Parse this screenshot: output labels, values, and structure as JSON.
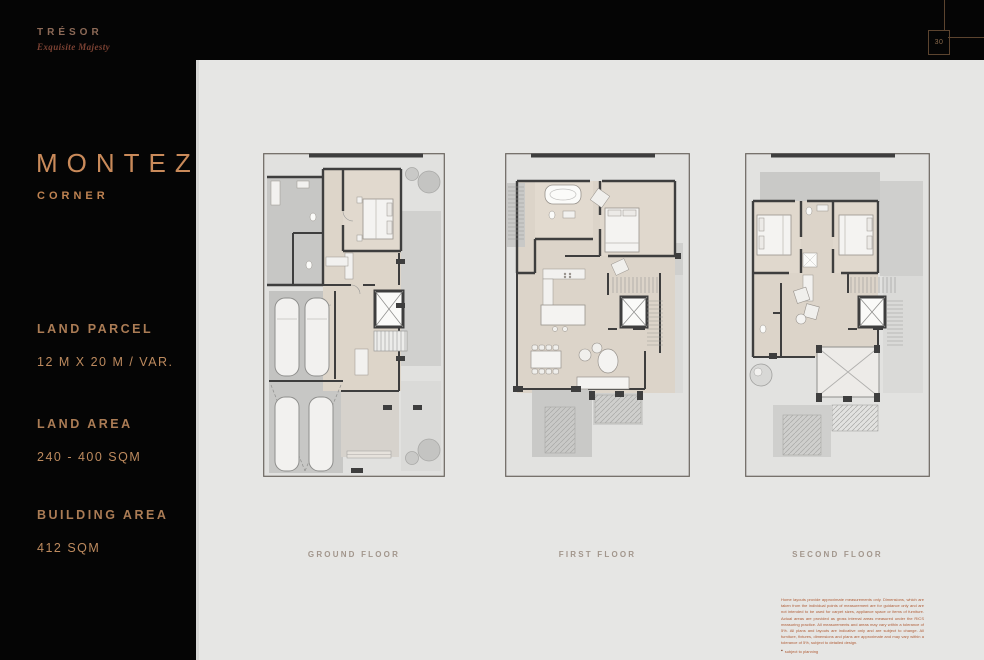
{
  "brand": {
    "name": "TRÉSOR",
    "tagline": "Exquisite Majesty"
  },
  "page_marker": {
    "number": "30"
  },
  "unit": {
    "name": "MONTEZ",
    "type": "CORNER"
  },
  "specs": [
    {
      "label": "LAND PARCEL",
      "value": "12 M X 20 M / VAR."
    },
    {
      "label": "LAND AREA",
      "value": "240 - 400 SQM"
    },
    {
      "label": "BUILDING AREA",
      "value": "412 SQM"
    }
  ],
  "floors": [
    {
      "label": "GROUND FLOOR"
    },
    {
      "label": "FIRST FLOOR"
    },
    {
      "label": "SECOND FLOOR"
    }
  ],
  "disclaimer": {
    "text": "Home layouts provide approximate measurements only. Dimensions, which are taken from the individual points of measurement are for guidance only and are not intended to be used for carpet sizes, appliance space or items of furniture. Actual areas are provided as gross internal areas measured under the RICS measuring practice. All measurements and areas may vary within a tolerance of 5%. All plans and layouts are indicative only and are subject to change. All furniture, fixtures, dimensions and plans are approximate and may vary within a tolerance of 5%, subject to detailed design.",
    "bullet_icon": "▪",
    "footnote": "subject to planning"
  },
  "colors": {
    "background": "#050505",
    "panel": "#E6E6E4",
    "accent": "#C98A5A",
    "brand": "#8D6A57",
    "disclaimer": "#B05C35"
  }
}
